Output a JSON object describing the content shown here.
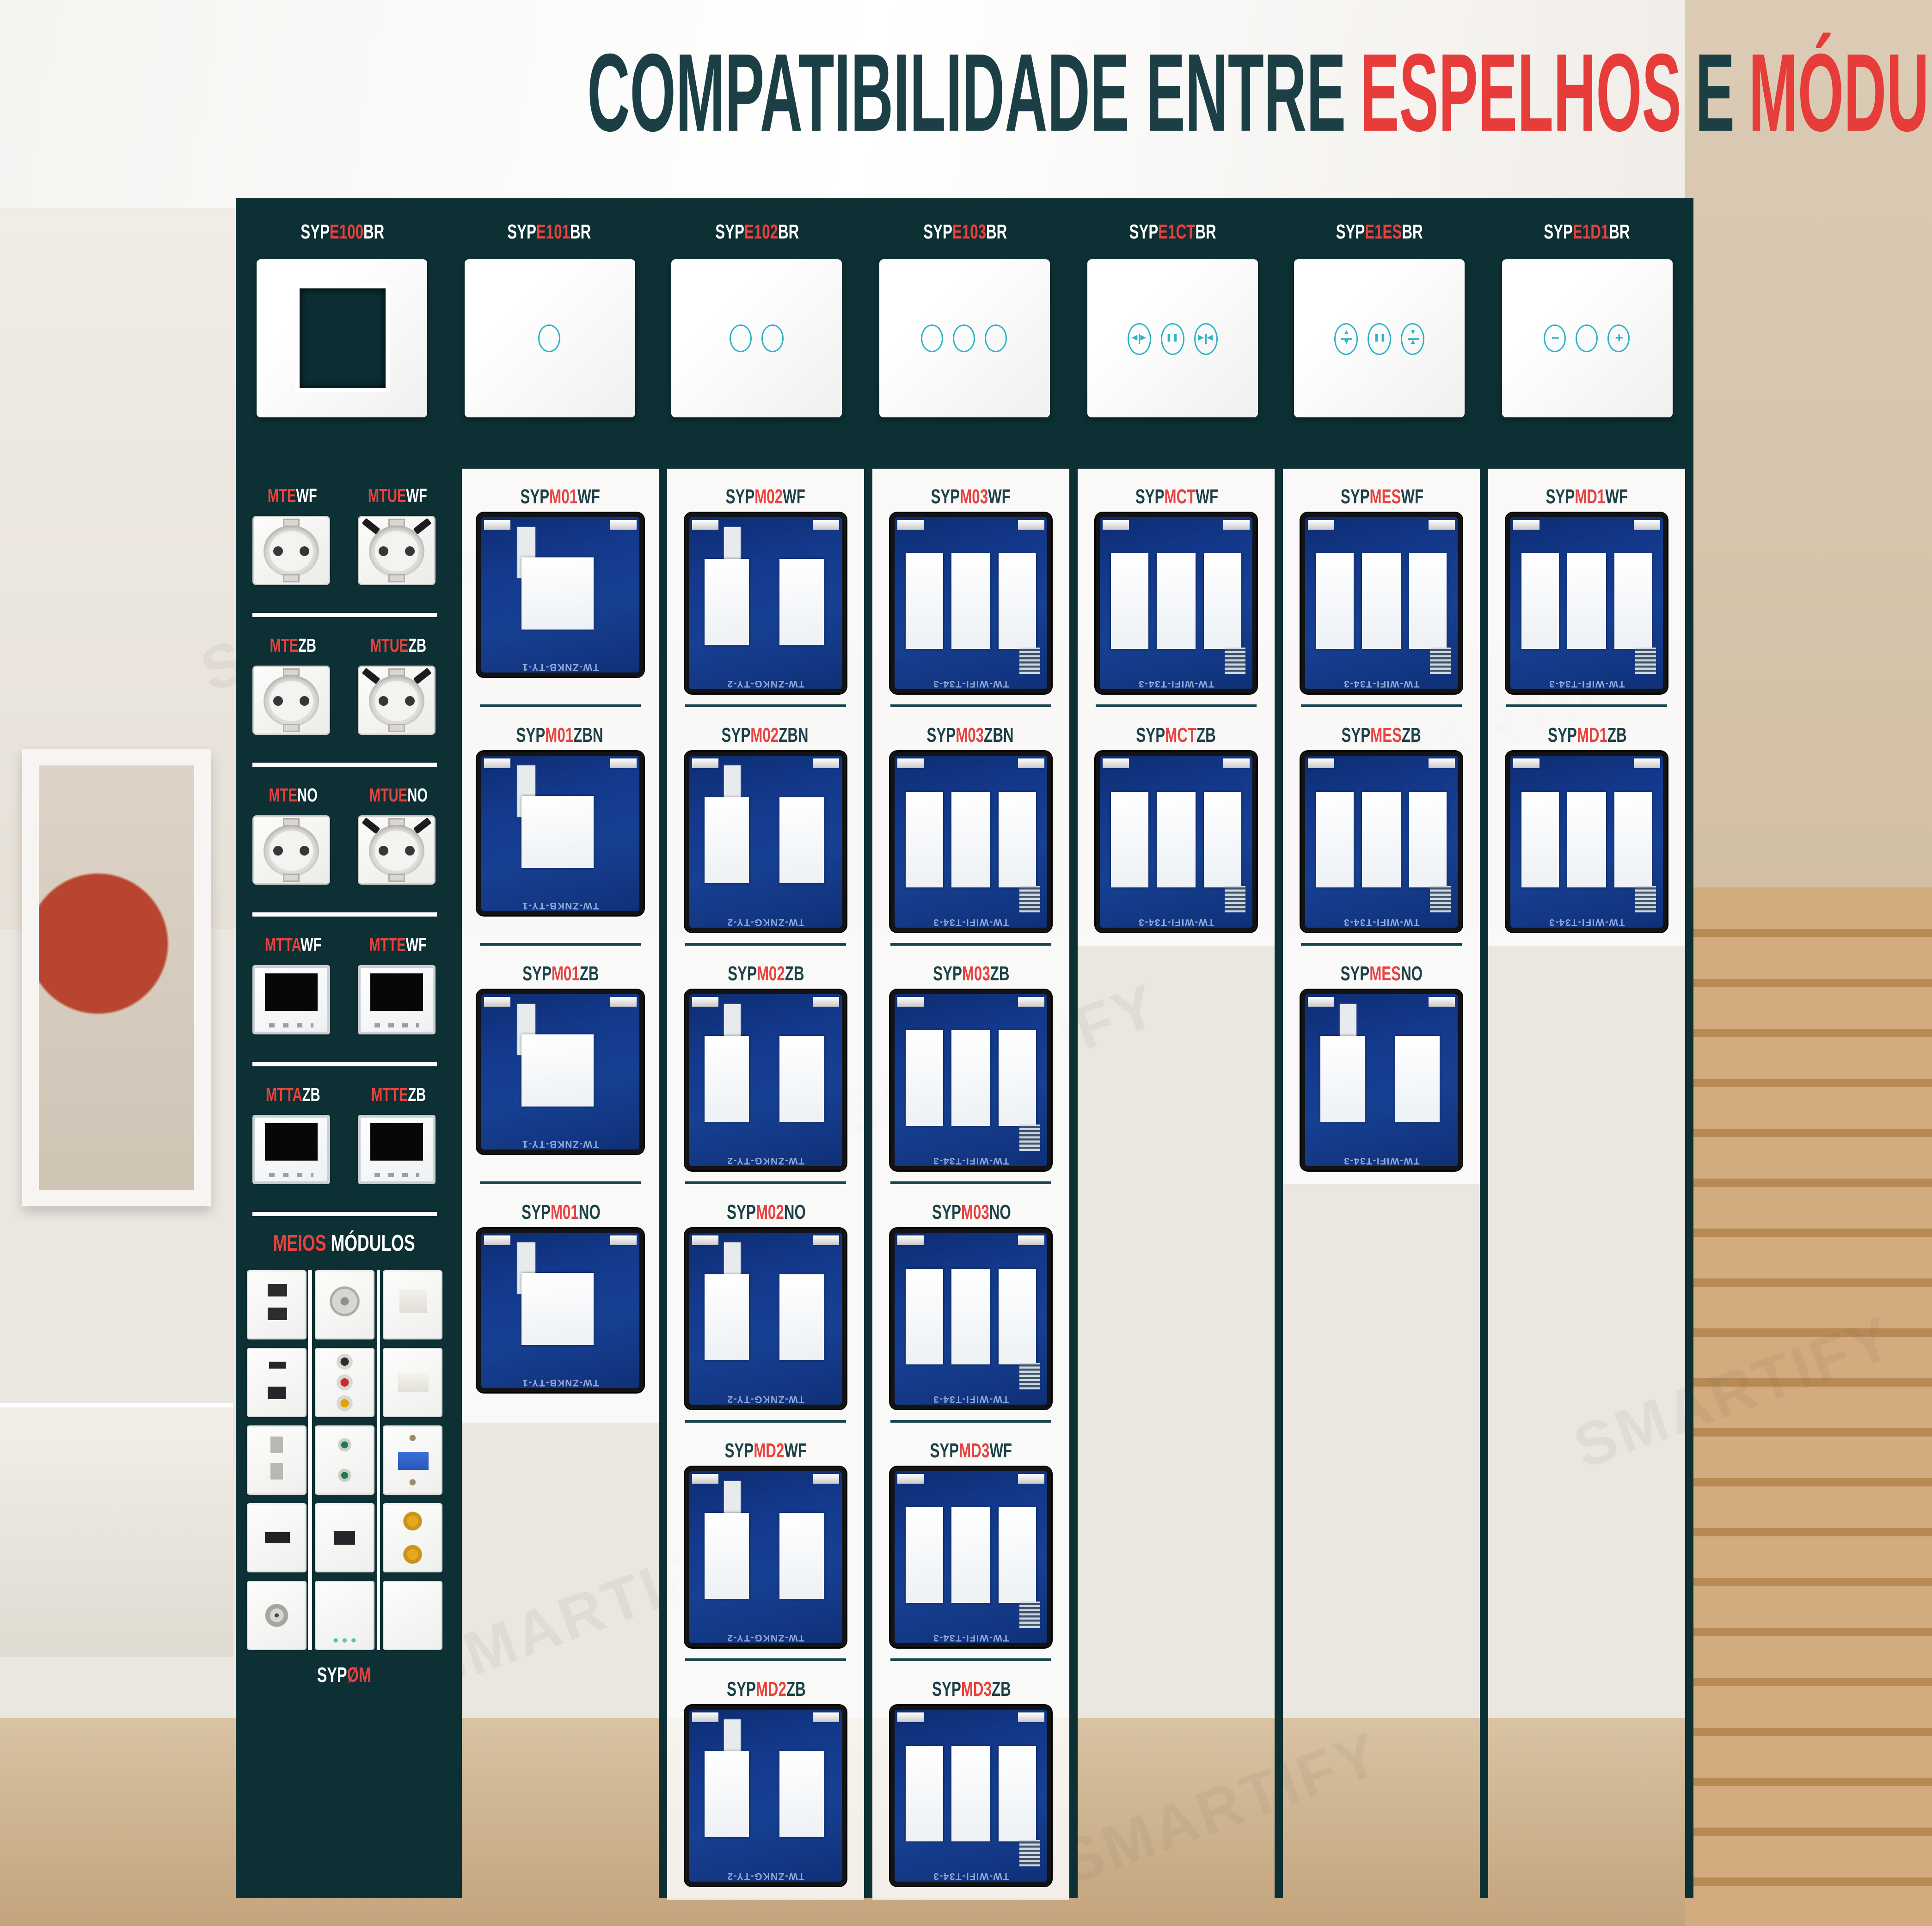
{
  "watermark": "SMARTIFY",
  "colors": {
    "teal_dark": "#0d3034",
    "teal_text": "#1c4147",
    "red": "#e8423f",
    "icon_teal": "#2db4c6"
  },
  "title": {
    "part1": "COMPATIBILIDADE ENTRE",
    "part2": "ESPELHOS",
    "part3": "E",
    "part4": "MÓDULOS"
  },
  "header": {
    "products": [
      {
        "prefix": "SYP",
        "code": "E100",
        "suffix": "BR",
        "icon": "frame-window"
      },
      {
        "prefix": "SYP",
        "code": "E101",
        "suffix": "BR",
        "icon": "touch-1-circle"
      },
      {
        "prefix": "SYP",
        "code": "E102",
        "suffix": "BR",
        "icon": "touch-2-circles"
      },
      {
        "prefix": "SYP",
        "code": "E103",
        "suffix": "BR",
        "icon": "touch-3-circles"
      },
      {
        "prefix": "SYP",
        "code": "E1CT",
        "suffix": "BR",
        "icon": "curtain-controls"
      },
      {
        "prefix": "SYP",
        "code": "E1ES",
        "suffix": "BR",
        "icon": "shutter-controls"
      },
      {
        "prefix": "SYP",
        "code": "E1D1",
        "suffix": "BR",
        "icon": "dimmer-controls"
      }
    ]
  },
  "sidebar": {
    "rows": [
      {
        "left": {
          "red": "MTE",
          "white": "WF",
          "icon": "eu-socket"
        },
        "right": {
          "red": "MTUE",
          "white": "WF",
          "icon": "eu-socket-usb"
        }
      },
      {
        "left": {
          "red": "MTE",
          "white": "ZB",
          "icon": "eu-socket"
        },
        "right": {
          "red": "MTUE",
          "white": "ZB",
          "icon": "eu-socket-usb"
        }
      },
      {
        "left": {
          "red": "MTE",
          "white": "NO",
          "icon": "eu-socket"
        },
        "right": {
          "red": "MTUE",
          "white": "NO",
          "icon": "eu-socket-usb"
        }
      },
      {
        "left": {
          "red": "MTTA",
          "white": "WF",
          "icon": "thermostat"
        },
        "right": {
          "red": "MTTE",
          "white": "WF",
          "icon": "thermostat"
        }
      },
      {
        "left": {
          "red": "MTTA",
          "white": "ZB",
          "icon": "thermostat"
        },
        "right": {
          "red": "MTTE",
          "white": "ZB",
          "icon": "thermostat"
        }
      }
    ],
    "meios": {
      "red": "MEIOS",
      "white": "MÓDULOS",
      "tiles": [
        "usb-double",
        "speaker",
        "rj45",
        "usb-c-usb-a",
        "rca-av",
        "rj45-cover",
        "socket-2pin",
        "audio-jacks",
        "vga",
        "hdmi",
        "usb-single",
        "rca-gold",
        "tv-coax",
        "blank-switch",
        "blank"
      ]
    },
    "footer": {
      "white": "SYP",
      "red": "ØM"
    }
  },
  "pcb_text": {
    "g1": "TW-ZNKB-TY-1",
    "g2": "TW-ZNKG-TY-2",
    "g3": "TW-WIFI-T34-3"
  },
  "columns": [
    {
      "modules": [
        {
          "prefix": "SYP",
          "code": "M01",
          "suffix": "WF"
        },
        {
          "prefix": "SYP",
          "code": "M01",
          "suffix": "ZBN"
        },
        {
          "prefix": "SYP",
          "code": "M01",
          "suffix": "ZB"
        },
        {
          "prefix": "SYP",
          "code": "M01",
          "suffix": "NO"
        }
      ]
    },
    {
      "modules": [
        {
          "prefix": "SYP",
          "code": "M02",
          "suffix": "WF"
        },
        {
          "prefix": "SYP",
          "code": "M02",
          "suffix": "ZBN"
        },
        {
          "prefix": "SYP",
          "code": "M02",
          "suffix": "ZB"
        },
        {
          "prefix": "SYP",
          "code": "M02",
          "suffix": "NO"
        },
        {
          "prefix": "SYP",
          "code": "MD2",
          "suffix": "WF"
        },
        {
          "prefix": "SYP",
          "code": "MD2",
          "suffix": "ZB"
        }
      ]
    },
    {
      "modules": [
        {
          "prefix": "SYP",
          "code": "M03",
          "suffix": "WF"
        },
        {
          "prefix": "SYP",
          "code": "M03",
          "suffix": "ZBN"
        },
        {
          "prefix": "SYP",
          "code": "M03",
          "suffix": "ZB"
        },
        {
          "prefix": "SYP",
          "code": "M03",
          "suffix": "NO"
        },
        {
          "prefix": "SYP",
          "code": "MD3",
          "suffix": "WF"
        },
        {
          "prefix": "SYP",
          "code": "MD3",
          "suffix": "ZB"
        }
      ]
    },
    {
      "modules": [
        {
          "prefix": "SYP",
          "code": "MCT",
          "suffix": "WF"
        },
        {
          "prefix": "SYP",
          "code": "MCT",
          "suffix": "ZB"
        }
      ]
    },
    {
      "modules": [
        {
          "prefix": "SYP",
          "code": "MES",
          "suffix": "WF"
        },
        {
          "prefix": "SYP",
          "code": "MES",
          "suffix": "ZB"
        },
        {
          "prefix": "SYP",
          "code": "MES",
          "suffix": "NO"
        }
      ]
    },
    {
      "modules": [
        {
          "prefix": "SYP",
          "code": "MD1",
          "suffix": "WF"
        },
        {
          "prefix": "SYP",
          "code": "MD1",
          "suffix": "ZB"
        }
      ]
    }
  ]
}
